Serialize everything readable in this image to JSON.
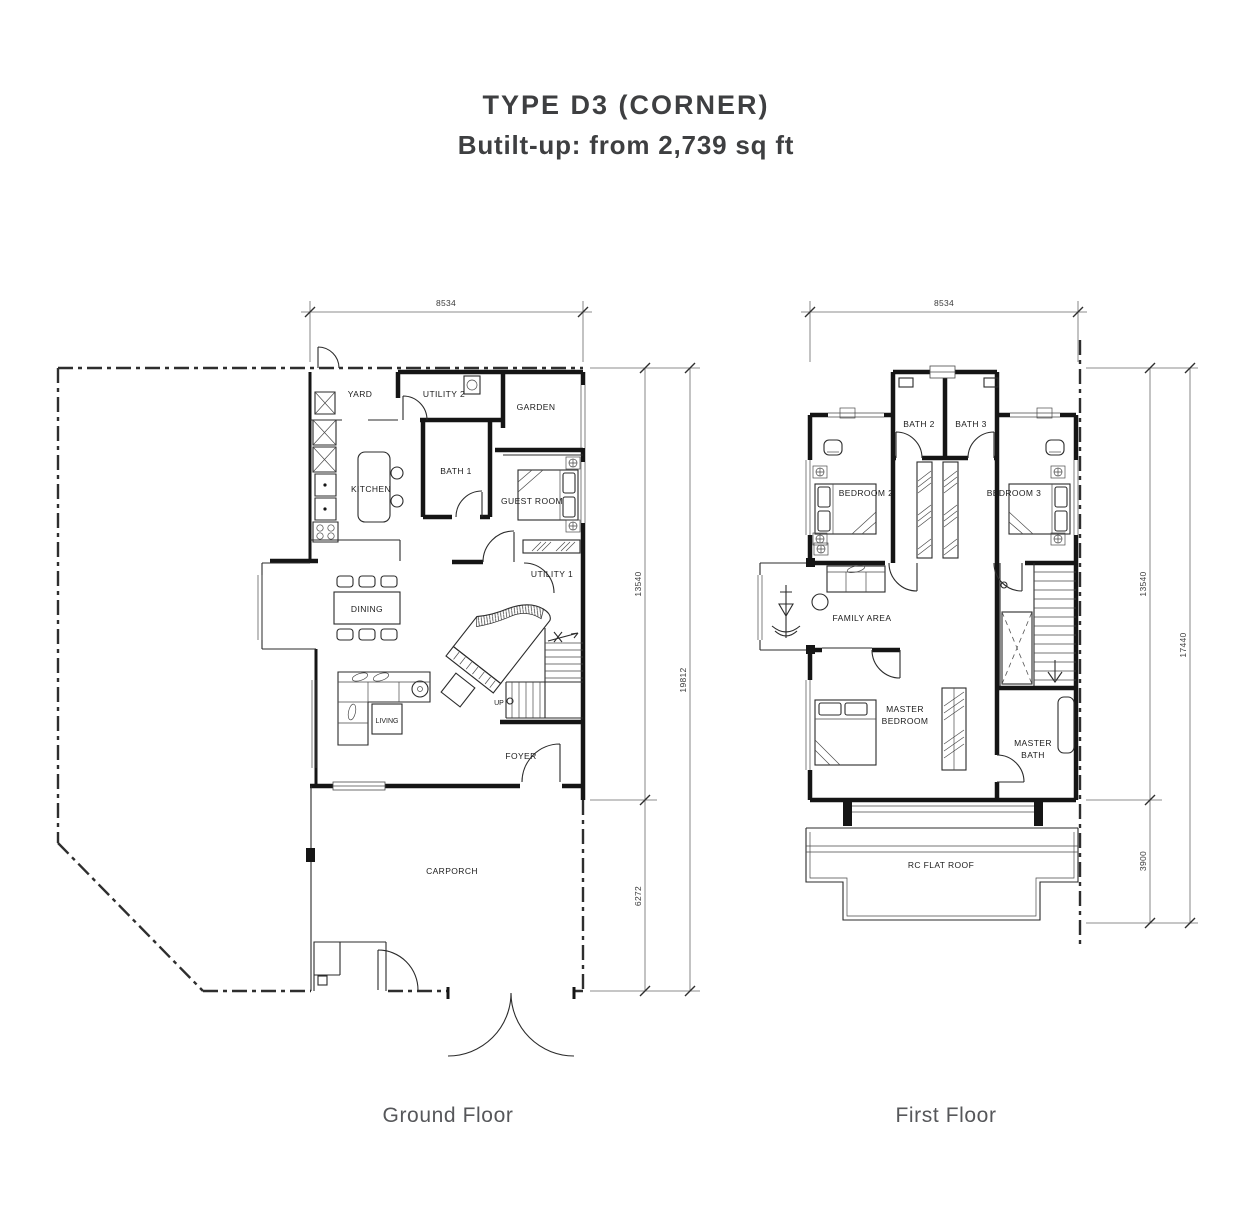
{
  "title": "TYPE D3 (CORNER)",
  "subtitle": "Butilt-up: from 2,739 sq ft",
  "colors": {
    "line": "#151515",
    "title_text": "#3e3f41",
    "caption_text": "#56575a",
    "background": "#ffffff"
  },
  "ground_floor": {
    "caption": "Ground Floor",
    "dimensions": {
      "width_top": "8534",
      "depth_upper": "13540",
      "depth_total": "19812",
      "depth_lower": "6272"
    },
    "rooms": {
      "yard": "YARD",
      "utility2": "UTILITY 2",
      "garden": "GARDEN",
      "kitchen": "KITCHEN",
      "bath1": "BATH 1",
      "guest": "GUEST ROOM",
      "utility1": "UTILITY 1",
      "dining": "DINING",
      "living": "LIVING",
      "up": "UP",
      "foyer": "FOYER",
      "carporch": "CARPORCH"
    }
  },
  "first_floor": {
    "caption": "First Floor",
    "dimensions": {
      "width_top": "8534",
      "depth_upper": "13540",
      "depth_total": "17440",
      "depth_lower": "3900"
    },
    "rooms": {
      "bath2": "BATH 2",
      "bath3": "BATH 3",
      "bedroom2": "BEDROOM 2",
      "bedroom3": "BEDROOM 3",
      "family": "FAMILY AREA",
      "master_bedroom_lines": [
        "MASTER",
        "BEDROOM"
      ],
      "master_bath_lines": [
        "MASTER",
        "BATH"
      ],
      "roof": "RC FLAT ROOF"
    }
  }
}
